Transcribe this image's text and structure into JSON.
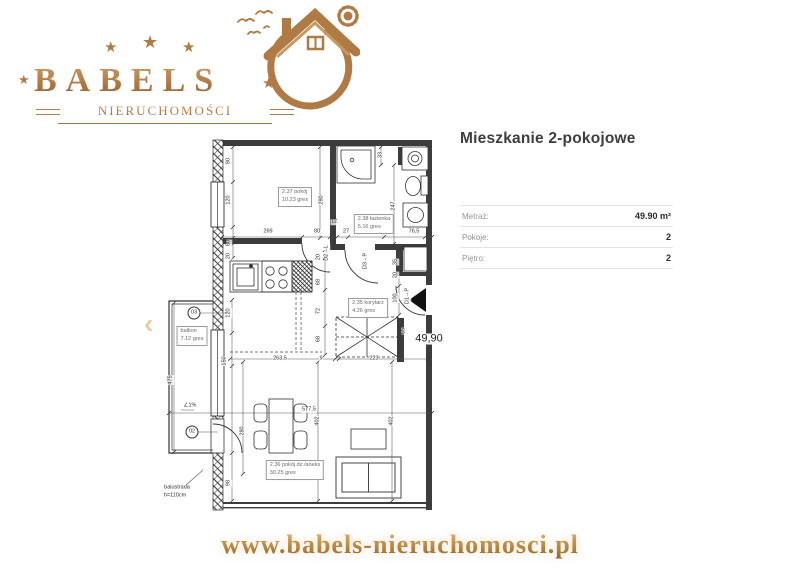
{
  "logo": {
    "brand": "BABELS",
    "subtitle": "NIERUCHOMOŚCI",
    "star": "★",
    "accent_gold": "#b07a45"
  },
  "carousel": {
    "prev_icon": "‹"
  },
  "listing": {
    "title": "Mieszkanie 2-pokojowe",
    "details": [
      {
        "label": "Metraż:",
        "value": "49.90 m²"
      },
      {
        "label": "Pokoje:",
        "value": "2"
      },
      {
        "label": "Piętro:",
        "value": "2"
      }
    ]
  },
  "floorplan": {
    "rooms": [
      {
        "x": 295,
        "y": 197,
        "lines": [
          "2.37  pokój",
          "10.23 gres"
        ]
      },
      {
        "x": 374,
        "y": 224,
        "lines": [
          "2.38  łazienka",
          "5.16  gres"
        ]
      },
      {
        "x": 368,
        "y": 308,
        "lines": [
          "2.35  korytarz",
          "4.26  gres"
        ]
      },
      {
        "x": 295,
        "y": 470,
        "lines": [
          "2.36  pokój dz./aneks",
          "30.25 gres"
        ]
      },
      {
        "x": 192,
        "y": 336,
        "lines": [
          "balkon",
          "7.12 gres"
        ]
      }
    ],
    "dims": [
      {
        "x": 268,
        "y": 232,
        "t": "269"
      },
      {
        "x": 317,
        "y": 232,
        "t": "80"
      },
      {
        "x": 334,
        "y": 222,
        "t": "12"
      },
      {
        "x": 346,
        "y": 232,
        "t": "27"
      },
      {
        "x": 367,
        "y": 232,
        "t": "90"
      },
      {
        "x": 414,
        "y": 232,
        "t": "76,5"
      },
      {
        "x": 229,
        "y": 161,
        "t": "80",
        "r": 1
      },
      {
        "x": 229,
        "y": 200,
        "t": "120",
        "r": 1
      },
      {
        "x": 229,
        "y": 243,
        "t": "60",
        "r": 1
      },
      {
        "x": 229,
        "y": 256,
        "t": "20",
        "r": 1
      },
      {
        "x": 322,
        "y": 200,
        "t": "280",
        "r": 1
      },
      {
        "x": 319,
        "y": 257,
        "t": "20",
        "r": 1
      },
      {
        "x": 319,
        "y": 282,
        "t": "68",
        "r": 1
      },
      {
        "x": 319,
        "y": 311,
        "t": "72",
        "r": 1
      },
      {
        "x": 319,
        "y": 339,
        "t": "68",
        "r": 1
      },
      {
        "x": 381,
        "y": 155,
        "t": "33",
        "r": 1
      },
      {
        "x": 394,
        "y": 206,
        "t": "247",
        "r": 1
      },
      {
        "x": 396,
        "y": 262,
        "t": "35",
        "r": 1
      },
      {
        "x": 396,
        "y": 275,
        "t": "20",
        "r": 1
      },
      {
        "x": 396,
        "y": 298,
        "t": "100",
        "r": 1
      },
      {
        "x": 404,
        "y": 331,
        "t": "65",
        "r": 1
      },
      {
        "x": 327,
        "y": 253,
        "t": "D2→L",
        "r": 1
      },
      {
        "x": 366,
        "y": 261,
        "t": "D3→P",
        "r": 1
      },
      {
        "x": 408,
        "y": 296,
        "t": "D1→P",
        "r": 1
      },
      {
        "x": 229,
        "y": 313,
        "t": "120",
        "r": 1
      },
      {
        "x": 225,
        "y": 361,
        "t": "150",
        "r": 1
      },
      {
        "x": 171,
        "y": 380,
        "t": "475",
        "r": 1
      },
      {
        "x": 243,
        "y": 431,
        "t": "280",
        "r": 1
      },
      {
        "x": 229,
        "y": 483,
        "t": "98",
        "r": 1
      },
      {
        "x": 280,
        "y": 359,
        "t": "263,5"
      },
      {
        "x": 321,
        "y": 359,
        "t": "9"
      },
      {
        "x": 374,
        "y": 359,
        "t": "223"
      },
      {
        "x": 309,
        "y": 410,
        "t": "577,5"
      },
      {
        "x": 318,
        "y": 421,
        "t": "402",
        "r": 1
      },
      {
        "x": 392,
        "y": 421,
        "t": "402",
        "r": 1
      }
    ],
    "annotations": [
      {
        "t": "49,90",
        "x": 429,
        "y": 339,
        "cls": "area",
        "name": "total-area-label"
      },
      {
        "t": "∠1%",
        "x": 190,
        "y": 406,
        "cls": "",
        "name": "slope-label"
      },
      {
        "t": "balustrada",
        "x": 177,
        "y": 488,
        "cls": "",
        "name": "balustrade-label"
      },
      {
        "t": "h=110cm",
        "x": 175,
        "y": 496,
        "cls": "",
        "name": "balustrade-height-label"
      },
      {
        "t": "03",
        "x": 194,
        "y": 313,
        "cls": "circle",
        "name": "window-tag-03"
      },
      {
        "t": "02",
        "x": 192,
        "y": 432,
        "cls": "circle",
        "name": "door-tag-02"
      }
    ]
  },
  "footer": {
    "url": "www.babels-nieruchomosci.pl"
  }
}
